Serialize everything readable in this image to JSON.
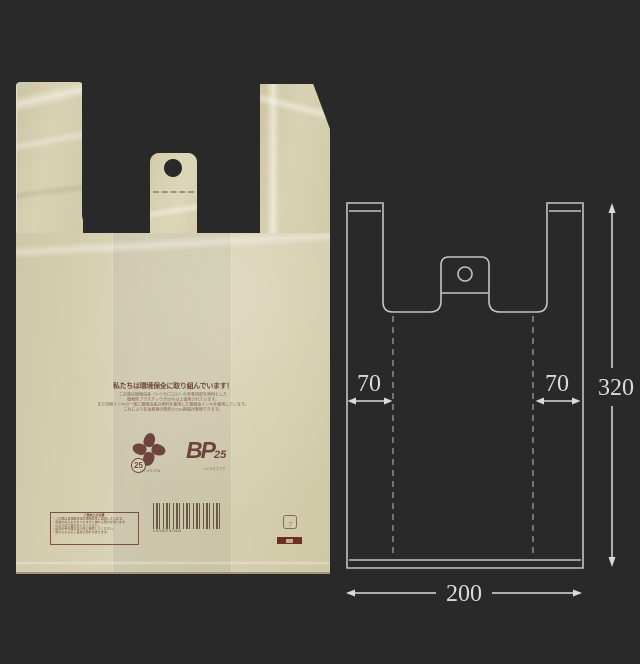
{
  "bag": {
    "headline": "私たちは環境保全に取り組んでいます！",
    "body_lines": [
      "この袋は植物由来（トウモロコシ）の非食用部を原料とした",
      "植物性プラスチックが25％以上使用されています。",
      "また印刷インキの一部に植物由来の原料を使用した植物油インキを使用しています。",
      "これにより石油資源の節約とCO₂削減が実現できます。"
    ],
    "biomass_mark": {
      "value": "25",
      "caption": "バイオマスPla"
    },
    "bp_mark": {
      "text": "BP",
      "value": "25",
      "caption": "バイオマスプラ"
    },
    "caution": {
      "title": "ご使用上の注意",
      "lines": [
        "・この袋は食品衛生法の規格基準に適合しています。",
        "・突起のあるものを入れますと破れる恐れがあります。",
        "・火のそばに置かないでください。",
        "・幼児の手の届かない所に保管してください。",
        "・頭からかぶると窒息の恐れがあります。"
      ]
    },
    "barcode_digits": "4 571372 371414",
    "plastic_mark": "プラ"
  },
  "diagram": {
    "dim_left_handle": "70",
    "dim_right_handle": "70",
    "dim_height": "320",
    "dim_width": "200"
  },
  "colors": {
    "background": "#292929",
    "bag_film": "#d6d0b2",
    "ink_maroon": "#6e453e",
    "diagram_line": "#c4c4c4"
  }
}
